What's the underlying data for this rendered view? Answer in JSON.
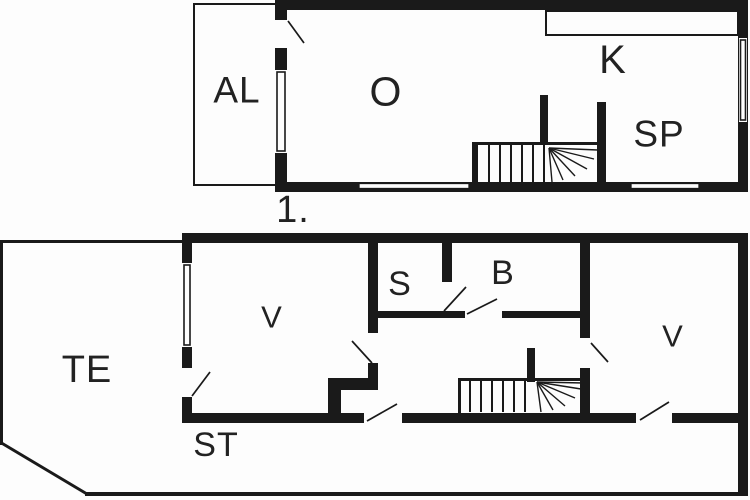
{
  "colors": {
    "wall": "#1a1a1a",
    "background": "#fdfdfd",
    "text": "#222222"
  },
  "labels": {
    "upper": {
      "al": "AL",
      "o": "O",
      "k": "K",
      "sp": "SP"
    },
    "floor_number": "1.",
    "lower": {
      "te": "TE",
      "v_left": "V",
      "s": "S",
      "b": "B",
      "v_right": "V",
      "st": "ST"
    }
  }
}
